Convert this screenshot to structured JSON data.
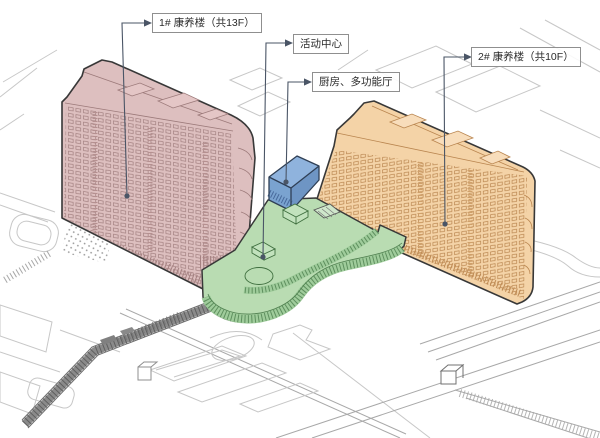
{
  "diagram": {
    "kind": "axonometric-site-massing-diagram",
    "callouts": [
      {
        "label": "1# 康养楼（共13F）",
        "target": "building-1-tower",
        "color": "#ddbfbf"
      },
      {
        "label": "活动中心",
        "target": "activity-center-podium",
        "color": "#b9dcb2"
      },
      {
        "label": "厨房、多功能厅",
        "target": "kitchen-multifunction-hall",
        "color": "#8fb3dd"
      },
      {
        "label": "2# 康养楼（共10F）",
        "target": "building-2-tower",
        "color": "#f4d3a7"
      }
    ],
    "colors": {
      "tower1_fill": "#ddbfbf",
      "tower2_fill": "#f4d3a7",
      "podium_fill": "#b9dcb2",
      "hall_fill": "#8fb3dd",
      "outline": "#383838",
      "leader": "#4a5566",
      "site_line": "#c7c7c7"
    }
  }
}
